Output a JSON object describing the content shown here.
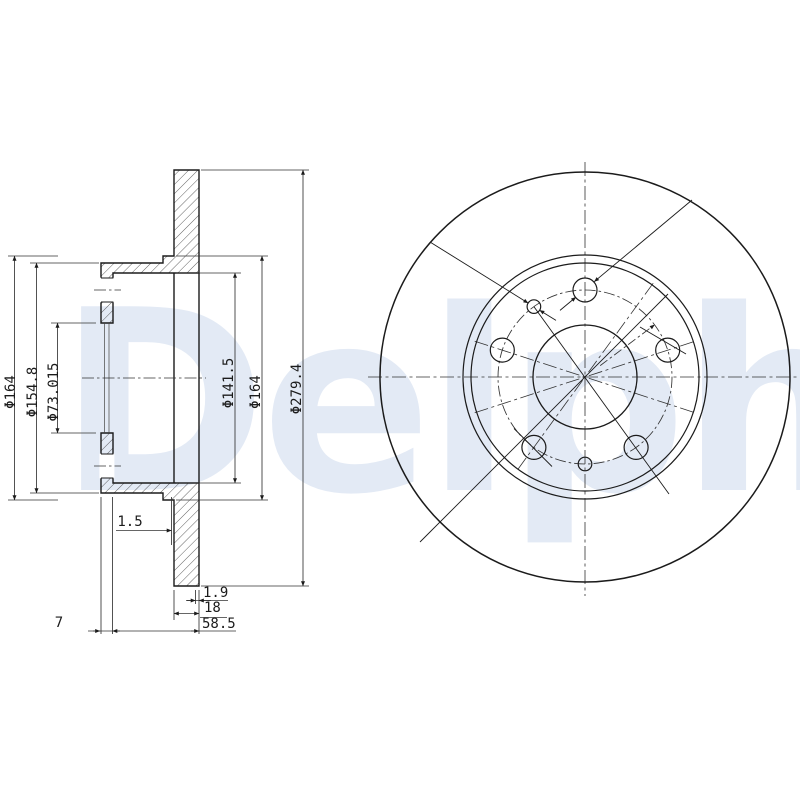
{
  "watermark": {
    "text": "Delphi",
    "color": "#e3eaf5"
  },
  "drawing": {
    "part": "brake-disc",
    "views": {
      "left": "cross-section",
      "right": "front"
    },
    "line_color": "#1b1b1b",
    "front_view": {
      "bolt_hole_count": 5,
      "locating_hole_count": 2
    }
  },
  "dimensions": {
    "flange_outer_dia": "Φ164",
    "hat_outer_dia": "Φ154.8",
    "bore_dia": "Φ73.015",
    "hat_inner_dia": "Φ141.5",
    "shoulder_dia": "Φ164",
    "disc_outer_dia": "Φ279.4",
    "hat_step": "1.5",
    "rim_step": "1.9",
    "disc_thickness": "18",
    "overall_height": "58.5",
    "flange_thickness": "7"
  }
}
